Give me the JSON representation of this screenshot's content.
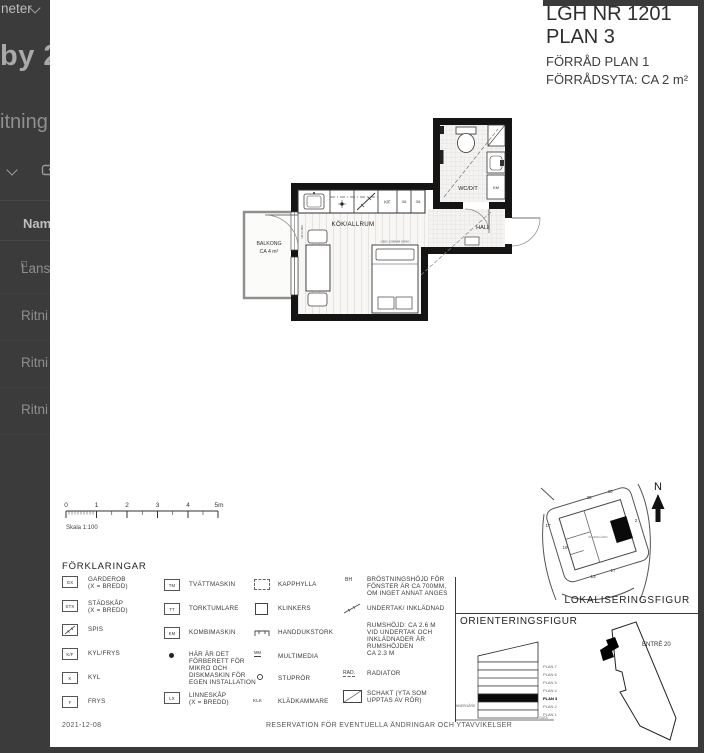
{
  "background_panel": {
    "top_item": "neter",
    "heading": "by 2:",
    "subheading": "itning",
    "table_header": "Nam",
    "rows": [
      {
        "label": "Lans"
      },
      {
        "label": "Ritni"
      },
      {
        "label": "Ritni"
      },
      {
        "label": "Ritni"
      }
    ]
  },
  "page": {
    "title_block": {
      "lgh": "LGH NR 1201",
      "plan": "PLAN 3",
      "forrad": "FÖRRÅD PLAN 1",
      "forradsyta": "FÖRRÅDSYTA: CA 2 m²"
    },
    "floor_plan": {
      "kok": "KÖK/ALLRUM",
      "hall": "HALL",
      "wc": "WC/D/T",
      "km": "KM",
      "kf": "K/F",
      "g6a": "G6",
      "g6b": "G6",
      "balkong1": "BALKONG",
      "balkong2": "CA 4 m²",
      "bed_note": "OBS! 1200MM SÄNG",
      "door_note": "UK±0 MM"
    },
    "scale_bar": {
      "ticks": [
        "0",
        "1",
        "2",
        "3",
        "4",
        "5m"
      ],
      "label": "Skala 1:100"
    },
    "legend": {
      "title": "FÖRKLARINGAR",
      "col1": [
        {
          "sym": "GX",
          "label": "GARDEROB\n(X = BREDD)"
        },
        {
          "sym": "STX",
          "label": "STÄDSKÅP\n(X = BREDD)"
        },
        {
          "sym": "",
          "label": "SPIS"
        },
        {
          "sym": "K/F",
          "label": "KYL/FRYS"
        },
        {
          "sym": "K",
          "label": "KYL"
        },
        {
          "sym": "F",
          "label": "FRYS"
        }
      ],
      "col2": [
        {
          "sym": "TM",
          "label": "TVÄTTMASKIN"
        },
        {
          "sym": "TT",
          "label": "TORKTUMLARE"
        },
        {
          "sym": "KM",
          "label": "KOMBIMASKIN"
        },
        {
          "sym": "",
          "label": "HÄR ÄR DET\nFÖRBERETT FÖR\nMIKRO OCH\nDISKMASKIN FÖR\nEGEN INSTALLATION"
        },
        {
          "sym": "LX",
          "label": "LINNESKÅP\n(X = BREDD)"
        }
      ],
      "col3": [
        {
          "sym": "",
          "label": "KAPPHYLLA"
        },
        {
          "sym": "",
          "label": "KLINKERS"
        },
        {
          "sym": "",
          "label": "HANDDUKSTORK"
        },
        {
          "sym": "MM",
          "label": "MULTIMEDIA"
        },
        {
          "sym": "",
          "label": "STUPRÖR"
        },
        {
          "sym": "KLK",
          "label": "KLÄDKAMMARE"
        }
      ],
      "col4": [
        {
          "sym": "BH",
          "label": "BRÖSTNINGSHÖJD FÖR\nFÖNSTER ÄR CA 700MM,\nOM INGET ANNAT ANGES"
        },
        {
          "sym": "",
          "label": "UNDERTAK/ INKLÄDNAD"
        },
        {
          "sym": "",
          "label": "RUMSHÖJD: CA 2.6 M\nVID UNDERTAK OCH\nINKLÄDNADER ÄR\nRUMSHÖJDEN\nCA 2.3 M"
        },
        {
          "sym": "RAD.",
          "label": "RADIATOR"
        },
        {
          "sym": "",
          "label": "SCHAKT (YTA SOM\nUPPTAS AV RÖR)"
        }
      ]
    },
    "lokalisering": {
      "title": "LOKALISERINGSFIGUR",
      "north": "N",
      "numbers": [
        "28",
        "30",
        "17",
        "19",
        "13",
        "17",
        "2"
      ],
      "innergard": "INNERGÅRD"
    },
    "orientering": {
      "title": "ORIENTERINGSFIGUR",
      "floors": [
        "PLAN 7",
        "PLAN 6",
        "PLAN 5",
        "PLAN 4",
        "PLAN 3",
        "PLAN 2",
        "PLAN 1"
      ],
      "innergard": "INNERGÅRD",
      "gata": "GATA",
      "entre": "ENTRÉ 20"
    },
    "footer": {
      "date": "2021-12-08",
      "reservation": "RESERVATION FÖR EVENTUELLA ÄNDRINGAR OCH YTAVVIKELSER"
    }
  }
}
